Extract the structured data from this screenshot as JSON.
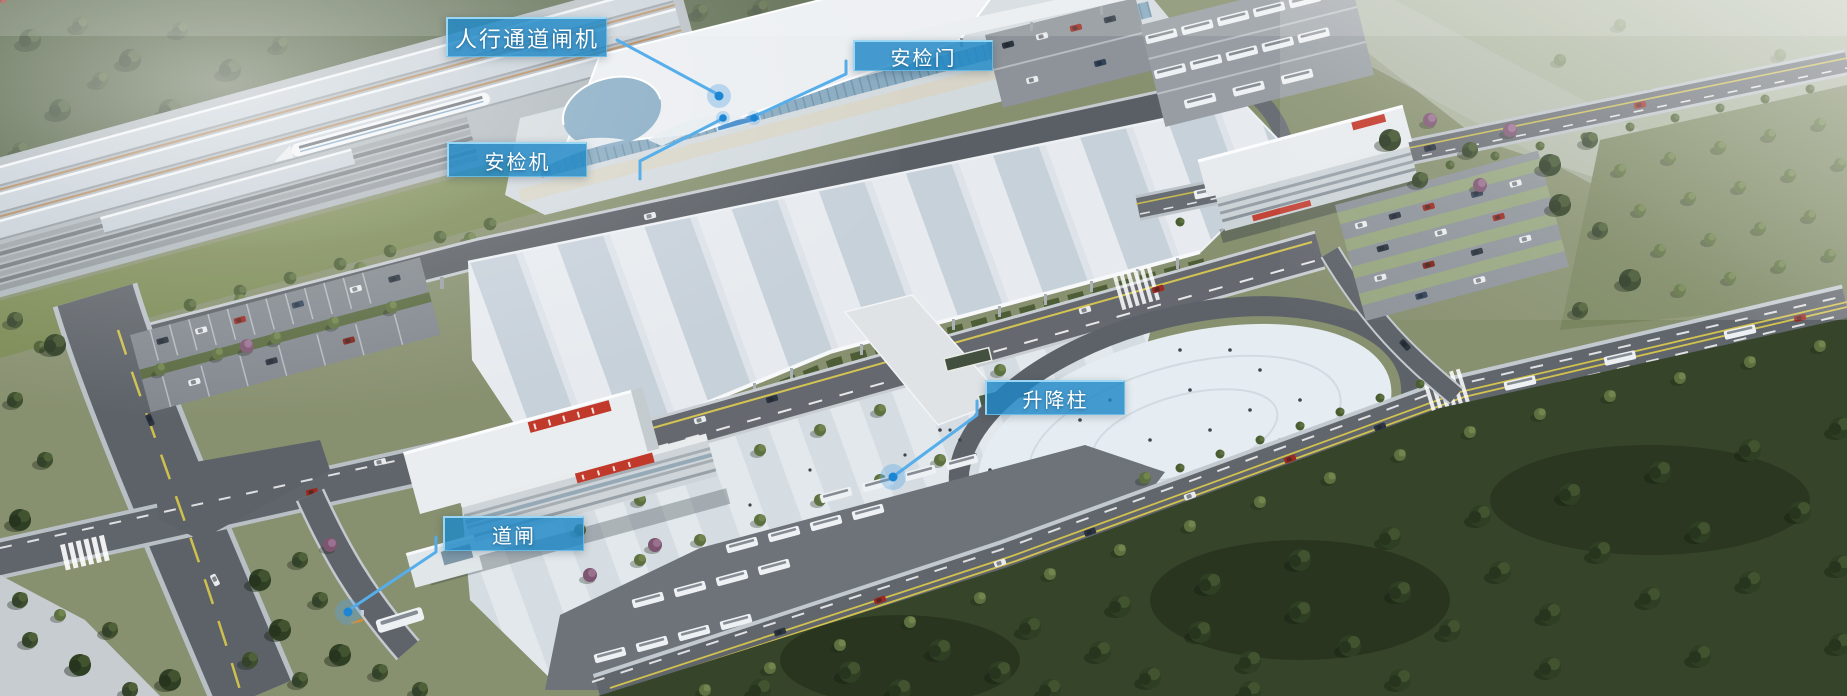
{
  "annotations": {
    "style": {
      "label_bg": "#1e88c6",
      "label_border": "#9edbf8",
      "line_color": "#56aeea",
      "dot_color": "#1d86d4"
    },
    "labels": [
      {
        "id": "pedestrian-lane-gate",
        "text": "人行通道闸机"
      },
      {
        "id": "security-door",
        "text": "安检门"
      },
      {
        "id": "security-scanner",
        "text": "安检机"
      },
      {
        "id": "rising-bollard",
        "text": "升降柱"
      },
      {
        "id": "barrier-gate",
        "text": "道闸"
      }
    ]
  }
}
